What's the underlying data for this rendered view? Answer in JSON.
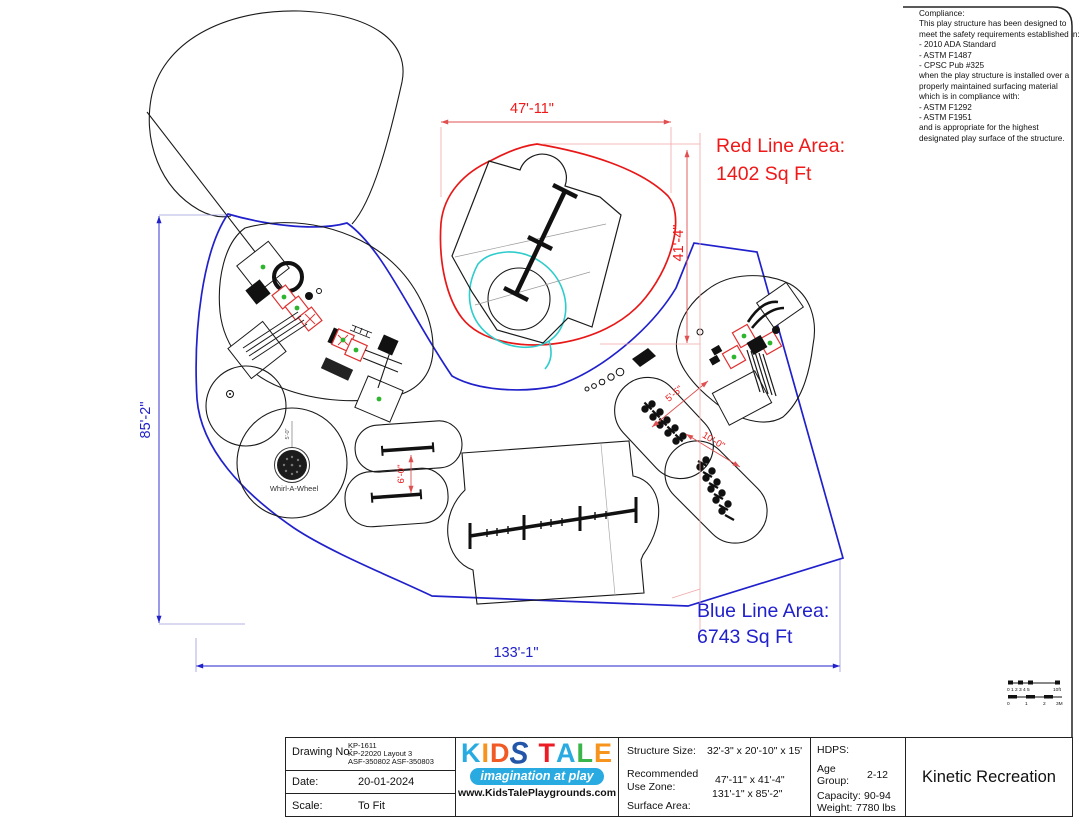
{
  "sheet": {
    "compliance": {
      "lines": [
        "Compliance:",
        "This play structure has been designed to",
        "meet the safety requirements established in:",
        "- 2010 ADA Standard",
        "- ASTM F1487",
        "- CPSC Pub #325",
        "when the play structure is installed over a",
        "properly maintained surfacing material",
        "which is in compliance with:",
        "- ASTM F1292",
        "- ASTM F1951",
        "and is appropriate for the highest",
        "designated play surface of the structure."
      ]
    }
  },
  "plan": {
    "red_area_label": [
      "Red Line Area:",
      "1402 Sq Ft"
    ],
    "blue_area_label": [
      "Blue Line Area:",
      "6743 Sq Ft"
    ],
    "dims": {
      "top": "47'-11\"",
      "right": "41'-4\"",
      "left": "85'-2\"",
      "bottom": "133'-1\"",
      "pill_gap": "6'-0\"",
      "rider_gap_1": "5'-5\"",
      "rider_gap_2": "10'-0\"",
      "whirl_radius": "5'-0\""
    },
    "labels": {
      "whirl": "Whirl-A-Wheel"
    },
    "scale_bar": {
      "ft_ticks": "0 1 2 3 4 5",
      "ft_end": "10ft",
      "m_0": "0",
      "m_1": "1",
      "m_2": "2",
      "m_3": "3M"
    },
    "colors": {
      "blue": "#2121cc",
      "red": "#f01818",
      "dim_red": "#e05050",
      "ext_pink": "#f2a6a6",
      "cyan": "#2ecccc",
      "green": "#2db52d"
    }
  },
  "title_block": {
    "drawing_no_label": "Drawing No:",
    "drawing_no_lines": [
      "KP-1611",
      "KP-22020 Layout 3",
      "ASF-350802 ASF-350803"
    ],
    "date_label": "Date:",
    "date_value": "20-01-2024",
    "scale_label": "Scale:",
    "scale_value": "To Fit",
    "logo": {
      "letters": [
        {
          "ch": "K",
          "color": "#29abe2"
        },
        {
          "ch": "I",
          "color": "#f7941d"
        },
        {
          "ch": "D",
          "color": "#f15a24"
        },
        {
          "ch": "S",
          "color": "#2356a8"
        },
        {
          "ch": "T",
          "color": "#ed1c24"
        },
        {
          "ch": "A",
          "color": "#29abe2"
        },
        {
          "ch": "L",
          "color": "#39b54a"
        },
        {
          "ch": "E",
          "color": "#f7941d"
        }
      ],
      "tagline": "imagination at play",
      "tagline_bg": "#29abe2",
      "website": "www.KidsTalePlaygrounds.com"
    },
    "specs": {
      "structure_size_label": "Structure Size:",
      "structure_size_value": "32'-3\" x 20'-10\" x 15'",
      "use_zone_label_1": "Recommended",
      "use_zone_label_2": "Use Zone:",
      "use_zone_value": "47'-11\" x 41'-4\"",
      "surface_area_label": "Surface Area:",
      "surface_area_value": "131'-1\" x 85'-2\""
    },
    "hdps": {
      "hdps_label": "HDPS:",
      "age_label_1": "Age",
      "age_label_2": "Group:",
      "age_value": "2-12",
      "capacity_label": "Capacity:",
      "capacity_value": "90-94",
      "weight_label": "Weight:",
      "weight_value": "7780 lbs"
    },
    "company": "Kinetic Recreation"
  }
}
